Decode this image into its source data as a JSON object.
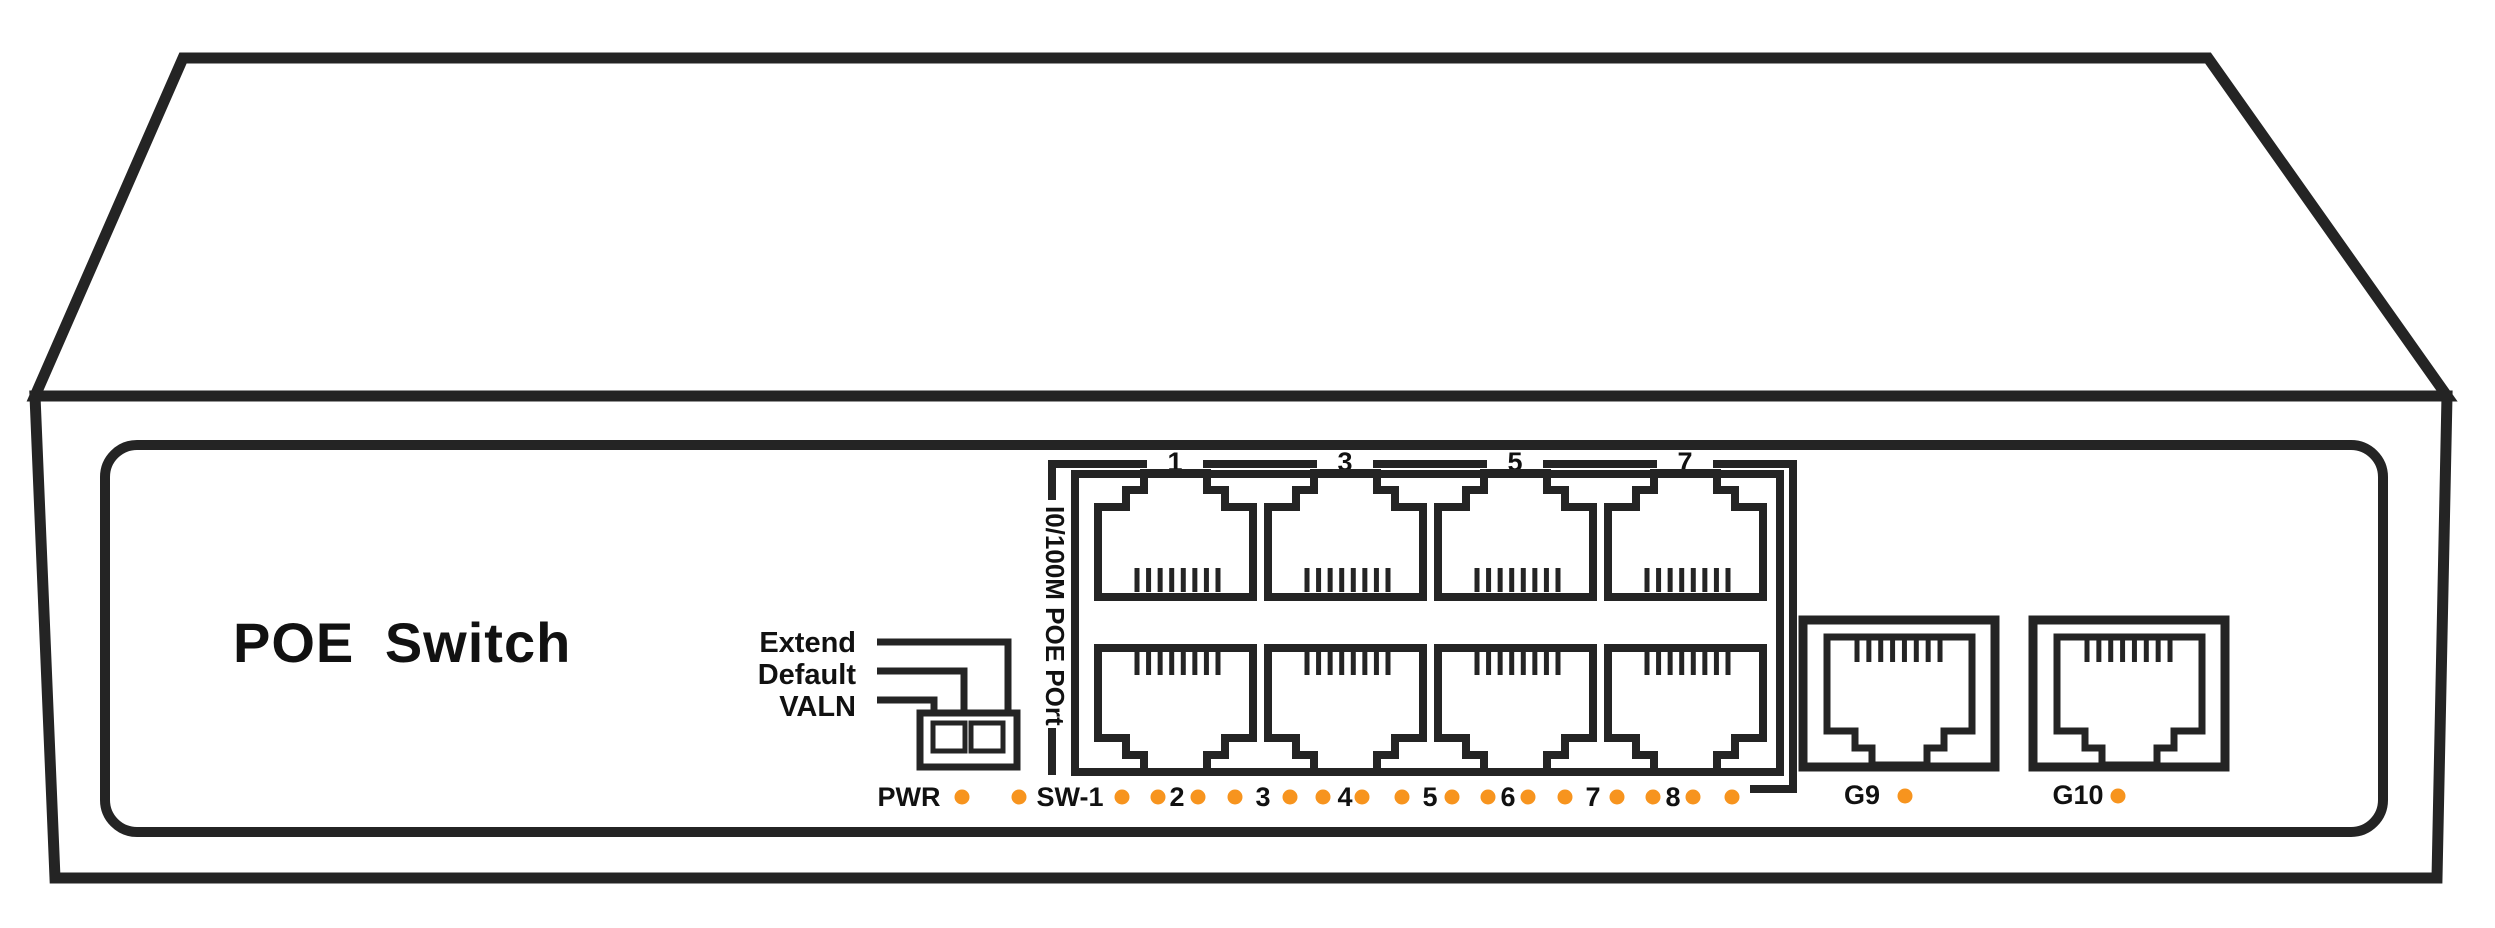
{
  "device": {
    "brand_label": "POE Switch"
  },
  "colors": {
    "line": "#242424",
    "text": "#111111",
    "led_on": "#F7941E",
    "background": "#ffffff"
  },
  "dip_switch": {
    "labels": [
      "Extend",
      "Default",
      "VALN"
    ],
    "positions": 2
  },
  "port_group": {
    "label": "I0/100M POE POrt",
    "top_numbers": [
      "1",
      "3",
      "5",
      "7"
    ],
    "poe_port_count": 8
  },
  "led_row": {
    "items": [
      {
        "t": "label",
        "x": 909,
        "text": "PWR"
      },
      {
        "t": "dot",
        "x": 962
      },
      {
        "t": "dot",
        "x": 1019
      },
      {
        "t": "label",
        "x": 1070,
        "text": "SW-1"
      },
      {
        "t": "dot",
        "x": 1122
      },
      {
        "t": "dot",
        "x": 1158
      },
      {
        "t": "label",
        "x": 1177,
        "text": "2"
      },
      {
        "t": "dot",
        "x": 1198
      },
      {
        "t": "dot",
        "x": 1235
      },
      {
        "t": "label",
        "x": 1263,
        "text": "3"
      },
      {
        "t": "dot",
        "x": 1290
      },
      {
        "t": "dot",
        "x": 1323
      },
      {
        "t": "label",
        "x": 1345,
        "text": "4"
      },
      {
        "t": "dot",
        "x": 1362
      },
      {
        "t": "dot",
        "x": 1402
      },
      {
        "t": "label",
        "x": 1430,
        "text": "5"
      },
      {
        "t": "dot",
        "x": 1452
      },
      {
        "t": "dot",
        "x": 1488
      },
      {
        "t": "label",
        "x": 1508,
        "text": "6"
      },
      {
        "t": "dot",
        "x": 1528
      },
      {
        "t": "dot",
        "x": 1565
      },
      {
        "t": "label",
        "x": 1593,
        "text": "7"
      },
      {
        "t": "dot",
        "x": 1617
      },
      {
        "t": "dot",
        "x": 1653
      },
      {
        "t": "label",
        "x": 1673,
        "text": "8"
      },
      {
        "t": "dot",
        "x": 1693
      },
      {
        "t": "dot",
        "x": 1732
      }
    ]
  },
  "uplinks": [
    {
      "label": "G9",
      "label_x": 1862,
      "dot_x": 1905
    },
    {
      "label": "G10",
      "label_x": 2078,
      "dot_x": 2118
    }
  ]
}
